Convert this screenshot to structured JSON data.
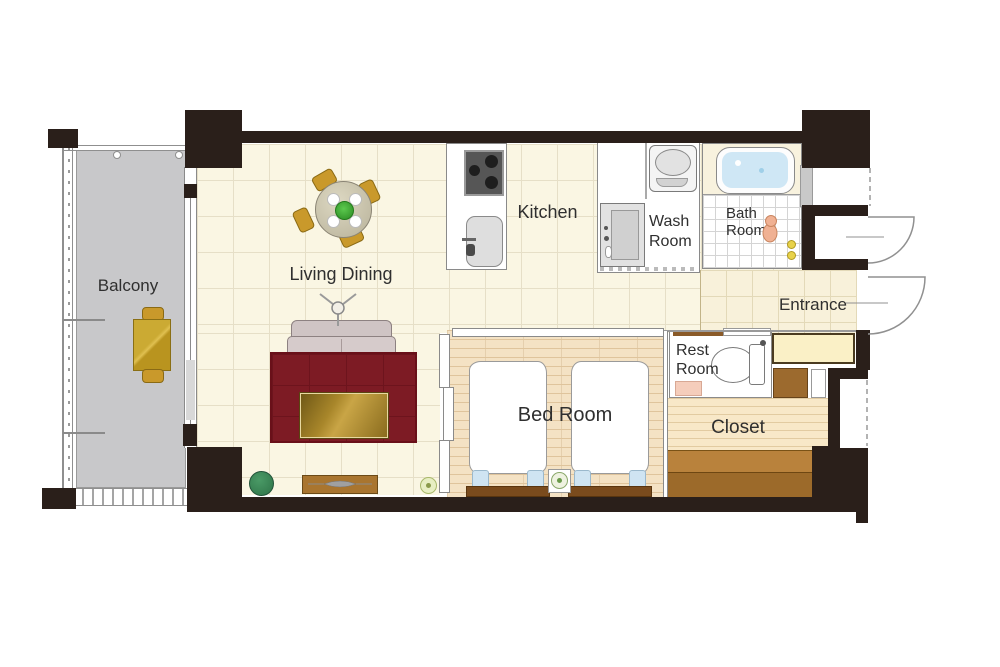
{
  "rooms": {
    "balcony": {
      "label": "Balcony"
    },
    "living_dining": {
      "label": "Living Dining"
    },
    "kitchen": {
      "label": "Kitchen"
    },
    "wash_room": {
      "line1": "Wash",
      "line2": "Room"
    },
    "bath_room": {
      "line1": "Bath",
      "line2": "Room"
    },
    "entrance": {
      "label": "Entrance"
    },
    "rest_room": {
      "line1": "Rest",
      "line2": "Room"
    },
    "closet": {
      "label": "Closet"
    },
    "bed_room": {
      "label": "Bed Room"
    }
  },
  "colors": {
    "wall": "#2a1f1a",
    "living_floor": "#faf6e3",
    "floor_grid": "#e6dfc7",
    "balcony_floor": "#c8c8ca",
    "bedroom_floor": "#f4e2c4",
    "closet_floor": "#f8e8c8",
    "step_wood": "#a9742f",
    "rug": "#7d1b24",
    "sofa": "#d4c9c9",
    "table_wood": "#b8912f",
    "chair_gold": "#c9992b",
    "bath_water": "#cfe7f5",
    "pillow_blue": "#cfe4f2",
    "headboard_brown": "#7a4b1d",
    "shoe_cabinet": "#faf0c6",
    "label_text": "#2f2f2f"
  },
  "icons": {
    "door-swing-icon": "quarter-arc",
    "boundary-dashed-icon": "dashed-line",
    "floor-lamp-icon": "tripod-lamp",
    "dining-table-icon": "round-table-4-chairs",
    "sofa-icon": "two-seat-sofa",
    "rug-icon": "area-rug",
    "coffee-table-icon": "wood-table",
    "tv-icon": "tv-on-board",
    "plant-icon": "potted-plant",
    "flower-icon": "small-plant",
    "stove-icon": "three-burner-stove",
    "sink-icon": "kitchen-basin",
    "washing-machine-icon": "top-load-washer",
    "vanity-icon": "washstand",
    "bathtub-icon": "tub-with-water",
    "shower-person-icon": "bathing-figure",
    "toilet-icon": "toilet-side-view",
    "bed-icon": "single-bed-duvet",
    "pillow-icon": "pillow",
    "nightstand-icon": "flower-nightstand",
    "balcony-table-icon": "table-two-chairs",
    "shoe-cabinet-icon": "entry-cabinet"
  }
}
